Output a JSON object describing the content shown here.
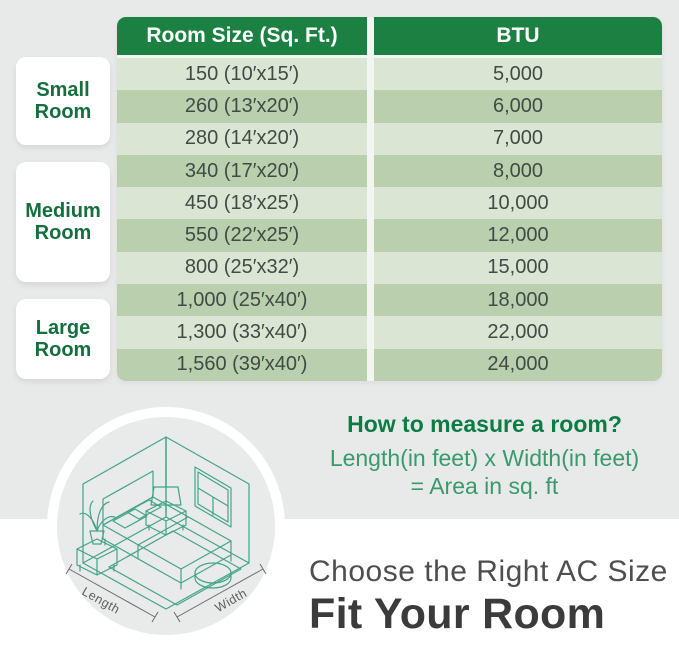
{
  "table": {
    "headers": {
      "room_size": "Room Size (Sq. Ft.)",
      "btu": "BTU"
    },
    "rows": [
      {
        "size": "150 (10′x15′)",
        "btu": "5,000"
      },
      {
        "size": "260 (13′x20′)",
        "btu": "6,000"
      },
      {
        "size": "280 (14′x20′)",
        "btu": "7,000"
      },
      {
        "size": "340 (17′x20′)",
        "btu": "8,000"
      },
      {
        "size": "450 (18′x25′)",
        "btu": "10,000"
      },
      {
        "size": "550 (22′x25′)",
        "btu": "12,000"
      },
      {
        "size": "800 (25′x32′)",
        "btu": "15,000"
      },
      {
        "size": "1,000 (25′x40′)",
        "btu": "18,000"
      },
      {
        "size": "1,300 (33′x40′)",
        "btu": "22,000"
      },
      {
        "size": "1,560 (39′x40′)",
        "btu": "24,000"
      }
    ]
  },
  "groups": [
    {
      "label": "Small Room"
    },
    {
      "label": "Medium Room"
    },
    {
      "label": "Large Room"
    }
  ],
  "how_to": {
    "title": "How to measure a room?",
    "line1": "Length(in feet) x Width(in feet)",
    "line2": "= Area in sq. ft"
  },
  "illustration": {
    "length_label": "Length",
    "width_label": "Width"
  },
  "footer": {
    "line1": "Choose the Right AC Size",
    "line2": "Fit Your Room"
  },
  "colors": {
    "header_green": "#1d8043",
    "row_light_green": "#dbe5d3",
    "row_dark_green": "#b9cfad",
    "label_green": "#146e3e",
    "howto_title_green": "#0c7c45",
    "howto_body_green": "#389a6d",
    "illustration_teal": "#43a489",
    "background_gray": "#e8e9e9",
    "footer_gray": "#3b3b3b"
  }
}
